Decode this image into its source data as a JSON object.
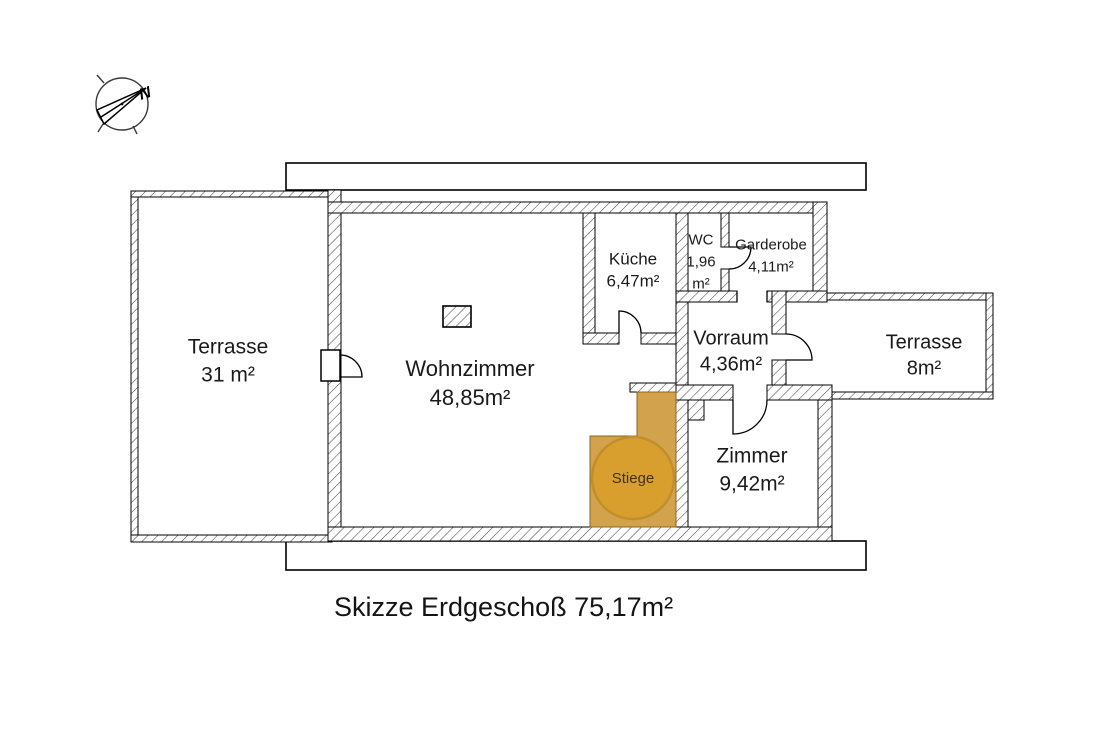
{
  "caption": "Skizze Erdgeschoß 75,17m²",
  "compass": {
    "label": "N"
  },
  "rooms": {
    "terrasse_links": {
      "name": "Terrasse",
      "area": "31 m²"
    },
    "wohnzimmer": {
      "name": "Wohnzimmer",
      "area": "48,85m²"
    },
    "kueche": {
      "name": "Küche",
      "area": "6,47m²"
    },
    "wc": {
      "name": "WC",
      "area": "1,96",
      "area_unit": "m²"
    },
    "garderobe": {
      "name": "Garderobe",
      "area": "4,11m²"
    },
    "vorraum": {
      "name": "Vorraum",
      "area": "4,36m²"
    },
    "terrasse_rechts": {
      "name": "Terrasse",
      "area": "8m²"
    },
    "zimmer": {
      "name": "Zimmer",
      "area": "9,42m²"
    },
    "stiege": {
      "name": "Stiege"
    }
  },
  "colors": {
    "stairs_fill": "#d3a24c",
    "stairs_circle": "#d89f2f",
    "stairs_border": "#8a6420",
    "line": "#000000",
    "hatch": "#4a4a4a"
  }
}
